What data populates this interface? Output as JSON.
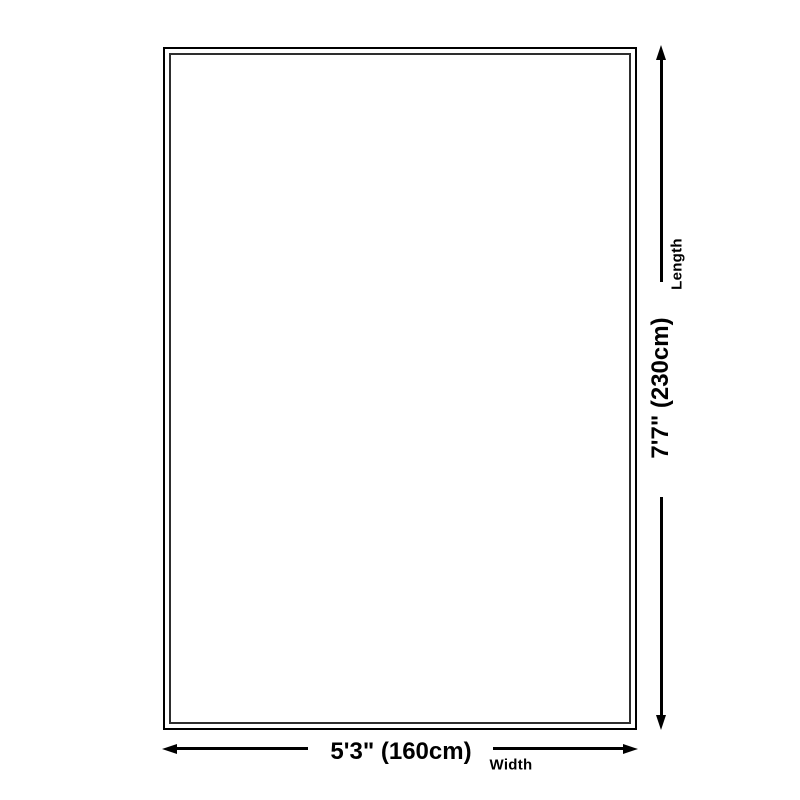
{
  "diagram": {
    "length": {
      "label": "Length",
      "value": "7'7\" (230cm)"
    },
    "width": {
      "label": "Width",
      "value": "5'3\" (160cm)"
    }
  },
  "colors": {
    "background": "#ffffff",
    "line": "#000000",
    "outer_border": "#000000",
    "inner_border": "#2e2e2e",
    "text": "#000000"
  }
}
